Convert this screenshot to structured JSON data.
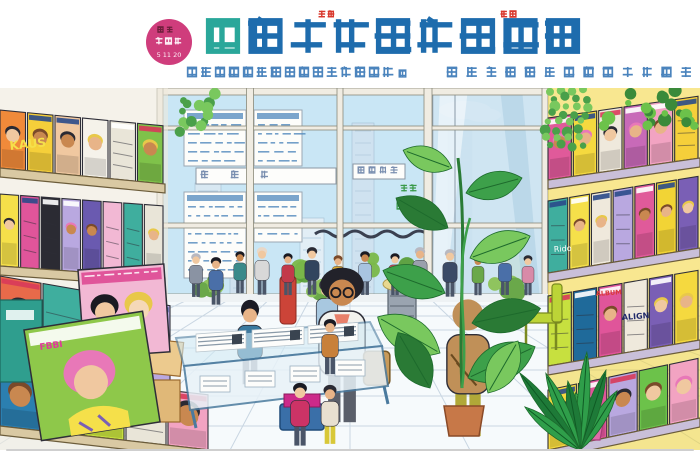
{
  "header": {
    "badge": {
      "bg": "#cf3d7c",
      "line1": "累期",
      "line2": "倉盟湖",
      "date": "5 11 20",
      "line1_color": "#6b1f3a",
      "line2_color": "#fdeef5"
    },
    "title": {
      "text": "臺拆大変言丸瘡芑菖",
      "color": "#1e6cad",
      "accent_color": "#2aa79a",
      "ruby_color": "#d8372c",
      "ruby": [
        {
          "text": "株光",
          "x": 318
        },
        {
          "text": "新売",
          "x": 500
        }
      ]
    },
    "subtitle": {
      "color": "#4b84bd",
      "left": "壺外窝式羊稚繭巌塁年切含歓銘白",
      "mark": "ュ",
      "right": "甶簷隆曼鞘繼麭舎碧簡毎瞹儀"
    }
  },
  "scene": {
    "sky": "#c9e6f5",
    "hedge_x": [
      215,
      320,
      505
    ],
    "signs": [
      {
        "text": "掛帯引",
        "x": 200,
        "y": 84,
        "s": 9,
        "sp": 30,
        "w": 140,
        "h": 16
      },
      {
        "text": "烟能雄男",
        "x": 357,
        "y": 80,
        "s": 8,
        "sp": 11,
        "w": 52,
        "h": 15
      }
    ],
    "glass_texts": [
      {
        "text": "営分",
        "x": 400,
        "y": 96
      },
      {
        "text": "今春",
        "x": 396,
        "y": 114
      }
    ],
    "posters": [
      {
        "x": 184,
        "y": 22,
        "w": 62,
        "h": 56,
        "rows": 5
      },
      {
        "x": 184,
        "y": 104,
        "w": 62,
        "h": 86,
        "rows": 8
      },
      {
        "x": 254,
        "y": 22,
        "w": 48,
        "h": 56,
        "rows": 5
      },
      {
        "x": 254,
        "y": 104,
        "w": 48,
        "h": 50,
        "rows": 4
      }
    ],
    "left_shelf": {
      "board": "#d9c9a3",
      "rows": [
        {
          "x0": 0,
          "y0": 80,
          "x1": 165,
          "y1": 96,
          "h": 58,
          "seed": 11,
          "covers": [
            "#f08a3a",
            "#f5cf3a",
            "#f0c8a0",
            "#f5f2ea",
            "#e9e5d8",
            "#7fc24a"
          ]
        },
        {
          "x0": 0,
          "y0": 178,
          "x1": 165,
          "y1": 190,
          "h": 72,
          "seed": 23,
          "covers": [
            "#f5e04a",
            "#e0559a",
            "#2b2b33",
            "#b9a8e0",
            "#6a5ab0",
            "#f2b8d4",
            "#3fae9e",
            "#e9e5d8"
          ]
        },
        {
          "x0": 0,
          "y0": 268,
          "x1": 172,
          "y1": 298,
          "h": 80,
          "seed": 37,
          "covers": [
            "#e86a4a",
            "#3fae9e",
            "#f2b8d4",
            "#b9a8e0"
          ]
        },
        {
          "x0": 0,
          "y0": 338,
          "x1": 210,
          "y1": 362,
          "h": 55,
          "seed": 41,
          "covers": [
            "#2b7fb0",
            "#3fae9e",
            "#c7e03f",
            "#e9e5d8",
            "#f2a3c2"
          ]
        }
      ]
    },
    "right_shelf": {
      "board": "#c9bfd9",
      "back": "#f2d435",
      "rows": [
        {
          "x0": 548,
          "y0": 92,
          "x1": 700,
          "y1": 70,
          "h": 62,
          "seed": 53,
          "covers": [
            "#e05a9a",
            "#f5d93f",
            "#efe9dc",
            "#c86ab8",
            "#f2a3c2",
            "#f5cf3a"
          ]
        },
        {
          "x0": 548,
          "y0": 185,
          "x1": 700,
          "y1": 160,
          "h": 72,
          "seed": 59,
          "covers": [
            "#3fae9e",
            "#f5e04a",
            "#efe9dc",
            "#b9a8e0",
            "#e05a9a",
            "#f2d435",
            "#7a5fb5"
          ]
        },
        {
          "x0": 548,
          "y0": 278,
          "x1": 700,
          "y1": 252,
          "h": 70,
          "seed": 67,
          "covers": [
            "#c7e03f",
            "#1f6a9a",
            "#e0559a",
            "#efe9dc",
            "#7a5fb5",
            "#f5d93f"
          ]
        },
        {
          "x0": 548,
          "y0": 362,
          "x1": 700,
          "y1": 330,
          "h": 60,
          "seed": 71,
          "covers": [
            "#f5d93f",
            "#e0559a",
            "#b9a8e0",
            "#6cc24a",
            "#f2a3c2"
          ]
        }
      ]
    },
    "cover_texts": [
      {
        "text": "KAUS",
        "x": 10,
        "y": 62,
        "size": 12,
        "color": "#f5e04a",
        "rot": -6,
        "bold": true
      },
      {
        "text": "FBBI",
        "x": 40,
        "y": 262,
        "size": 9,
        "color": "#e03a9a",
        "rot": -8,
        "bold": true
      },
      {
        "text": "Rido",
        "x": 554,
        "y": 164,
        "size": 8,
        "color": "#ffffff",
        "rot": -4,
        "bold": false
      },
      {
        "text": "ALIGN",
        "x": 622,
        "y": 232,
        "size": 8,
        "color": "#202a6a",
        "rot": -4,
        "bold": true
      },
      {
        "text": "ALBUM",
        "x": 596,
        "y": 208,
        "size": 6.5,
        "color": "#d83a3a",
        "rot": -4,
        "bold": true
      }
    ],
    "people_back": [
      {
        "x": 196,
        "y": 166,
        "h": 46,
        "top": "#8a93a3",
        "hair": "#b8b8c0",
        "skin": "#f0c8a0"
      },
      {
        "x": 216,
        "y": 170,
        "h": 50,
        "top": "#4a6fa8",
        "hair": "#1a1a22",
        "skin": "#e8b488"
      },
      {
        "x": 240,
        "y": 164,
        "h": 44,
        "top": "#3a8a8a",
        "hair": "#1a1a22",
        "skin": "#c98850"
      },
      {
        "x": 262,
        "y": 160,
        "h": 50,
        "top": "#d8d8d8",
        "hair": "#e8d8c8",
        "skin": "#f0c8a0"
      },
      {
        "x": 288,
        "y": 166,
        "h": 44,
        "top": "#c23a4a",
        "hair": "#1a1a22",
        "skin": "#e8b488"
      },
      {
        "x": 312,
        "y": 160,
        "h": 50,
        "top": "#32455e",
        "hair": "#2a2a33",
        "skin": "#f0c8a0"
      },
      {
        "x": 338,
        "y": 168,
        "h": 42,
        "top": "#d8a832",
        "hair": "#7a4a2a",
        "skin": "#e8b488"
      },
      {
        "x": 365,
        "y": 164,
        "h": 46,
        "top": "#a8c4e0",
        "hair": "#1a1a22",
        "skin": "#c98850"
      },
      {
        "x": 395,
        "y": 166,
        "h": 44,
        "top": "#d04a5a",
        "hair": "#1a1a22",
        "skin": "#f0c8a0"
      },
      {
        "x": 420,
        "y": 160,
        "h": 50,
        "top": "#9aa0ac",
        "hair": "#b8b8c0",
        "skin": "#e8b488"
      },
      {
        "x": 450,
        "y": 162,
        "h": 50,
        "top": "#3a4a66",
        "hair": "#b8b8c0",
        "skin": "#f0c8a0"
      },
      {
        "x": 478,
        "y": 168,
        "h": 42,
        "top": "#6aa84a",
        "hair": "#1a1a22",
        "skin": "#c98850"
      },
      {
        "x": 505,
        "y": 164,
        "h": 46,
        "top": "#4a6fa8",
        "hair": "#1a1a22",
        "skin": "#e8b488"
      },
      {
        "x": 528,
        "y": 168,
        "h": 42,
        "top": "#d88aa8",
        "hair": "#2a2a33",
        "skin": "#f0c8a0"
      }
    ],
    "people_mid": [
      {
        "x": 250,
        "y": 216,
        "h": 86,
        "top": "#3a7aa0",
        "hair": "#1a1a24",
        "skin": "#e8b488",
        "flags": "bob"
      },
      {
        "x": 327,
        "y": 192,
        "h": 75,
        "top": "#a8c8e0",
        "hair": "#3a3a44",
        "skin": "#f0c8a0"
      },
      {
        "x": 342,
        "y": 183,
        "h": 162,
        "top": "#f2f2ee",
        "hair": "#22222a",
        "skin": "#c98850",
        "bottom": "#5a5f6a",
        "flags": "afro glasses bag shirt"
      },
      {
        "x": 468,
        "y": 210,
        "h": 148,
        "top": "#c09058",
        "hair": "#c09058",
        "bottom": "#b0a838",
        "flags": "back",
        "skin": "#c98850"
      }
    ],
    "people_front": [
      {
        "x": 330,
        "y": 232,
        "h": 58,
        "top": "#c8803a",
        "hair": "#1a1a22",
        "skin": "#e8b488"
      },
      {
        "x": 300,
        "y": 296,
        "h": 66,
        "top": "#cc3366",
        "hair": "#1a1a22",
        "skin": "#f0c8a0"
      },
      {
        "x": 330,
        "y": 298,
        "h": 62,
        "top": "#e8e0d0",
        "bottom": "#d8c838",
        "hair": "#2a2a33",
        "skin": "#e8b488"
      }
    ],
    "feature_covers": {
      "coverA": {
        "bg": "#f2b8d4",
        "banner": "#e0559a",
        "hairA": "#1a1a22",
        "hairB": "#e8c84a"
      },
      "coverB": {
        "bg": "#8ec84a",
        "hair": "#e878b8",
        "accent": "#f5e04a"
      }
    },
    "counter": {
      "glass": "#d2ebf5",
      "frame": "#4a7a9e",
      "paper": "#fdfdfb",
      "ink": "#8a9aa8"
    },
    "tote": {
      "bin": "#3a6fa8",
      "stack": "#cc2a8a"
    },
    "boxes": [
      "#ecca8e",
      "#e0b878",
      "#f2f2ec"
    ],
    "plants": {
      "leaf_dark": "#2a7a35",
      "leaf_mid": "#3da04a",
      "leaf_light": "#79c85e",
      "fan_dark": "#1e7a38",
      "pot_terracotta": "#c77848",
      "pot_pink": "#e06aa8"
    }
  }
}
